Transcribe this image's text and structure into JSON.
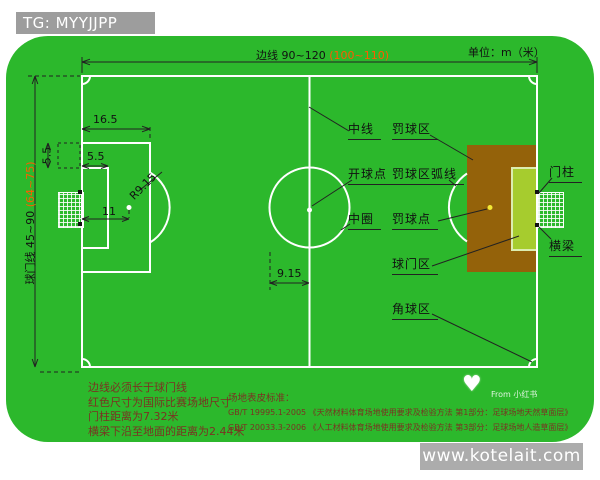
{
  "colors": {
    "field-green": "#2cb82c",
    "penalty-brown": "#94620a",
    "goalarea-yellow": "#a6cc2e",
    "goalarea-border": "#dcedb0",
    "spot-yellow": "#f2e935",
    "dim-red": "#ff5a00",
    "note-red": "#7a3322",
    "bar-gray": "#9d9d9d"
  },
  "watermark_bar": {
    "tag": "TG: MYYJJPP"
  },
  "footer": {
    "website": "www.kotelait.com"
  },
  "header": {
    "touchline": "边线 90~120",
    "touchline_intl": "(100~110)",
    "unit": "单位：m（米）"
  },
  "left_axis": {
    "goal_line": "球门线 45~90",
    "goal_line_intl": "(64~75)"
  },
  "dims": {
    "penalty_depth": "16.5",
    "goal_depth": "5.5",
    "goal_side": "5.5",
    "penalty_dist": "11",
    "arc_radius": "R9.15",
    "circle_radius": "9.15"
  },
  "labels": {
    "center_line": "中线",
    "penalty_area": "罚球区",
    "kickoff_point": "开球点",
    "penalty_arc": "罚球区弧线",
    "center_circle": "中圈",
    "penalty_spot": "罚球点",
    "goal_area": "球门区",
    "corner_area": "角球区",
    "goal_post": "门柱",
    "crossbar": "横梁"
  },
  "notes": [
    "边线必须长于球门线",
    "红色尺寸为国际比赛场地尺寸",
    "门柱距离为7.32米",
    "横梁下沿至地面的距离为2.44米"
  ],
  "standards": {
    "title": "场地表皮标准：",
    "lines": [
      "GB/T 19995.1-2005 《天然材料体育场地使用要求及检验方法 第1部分：足球场地天然草面层》",
      "GB/T 20033.3-2006 《人工材料体育场地使用要求及检验方法 第3部分：足球场地人造草面层》"
    ]
  },
  "watermark": {
    "source": "From 小红书"
  }
}
